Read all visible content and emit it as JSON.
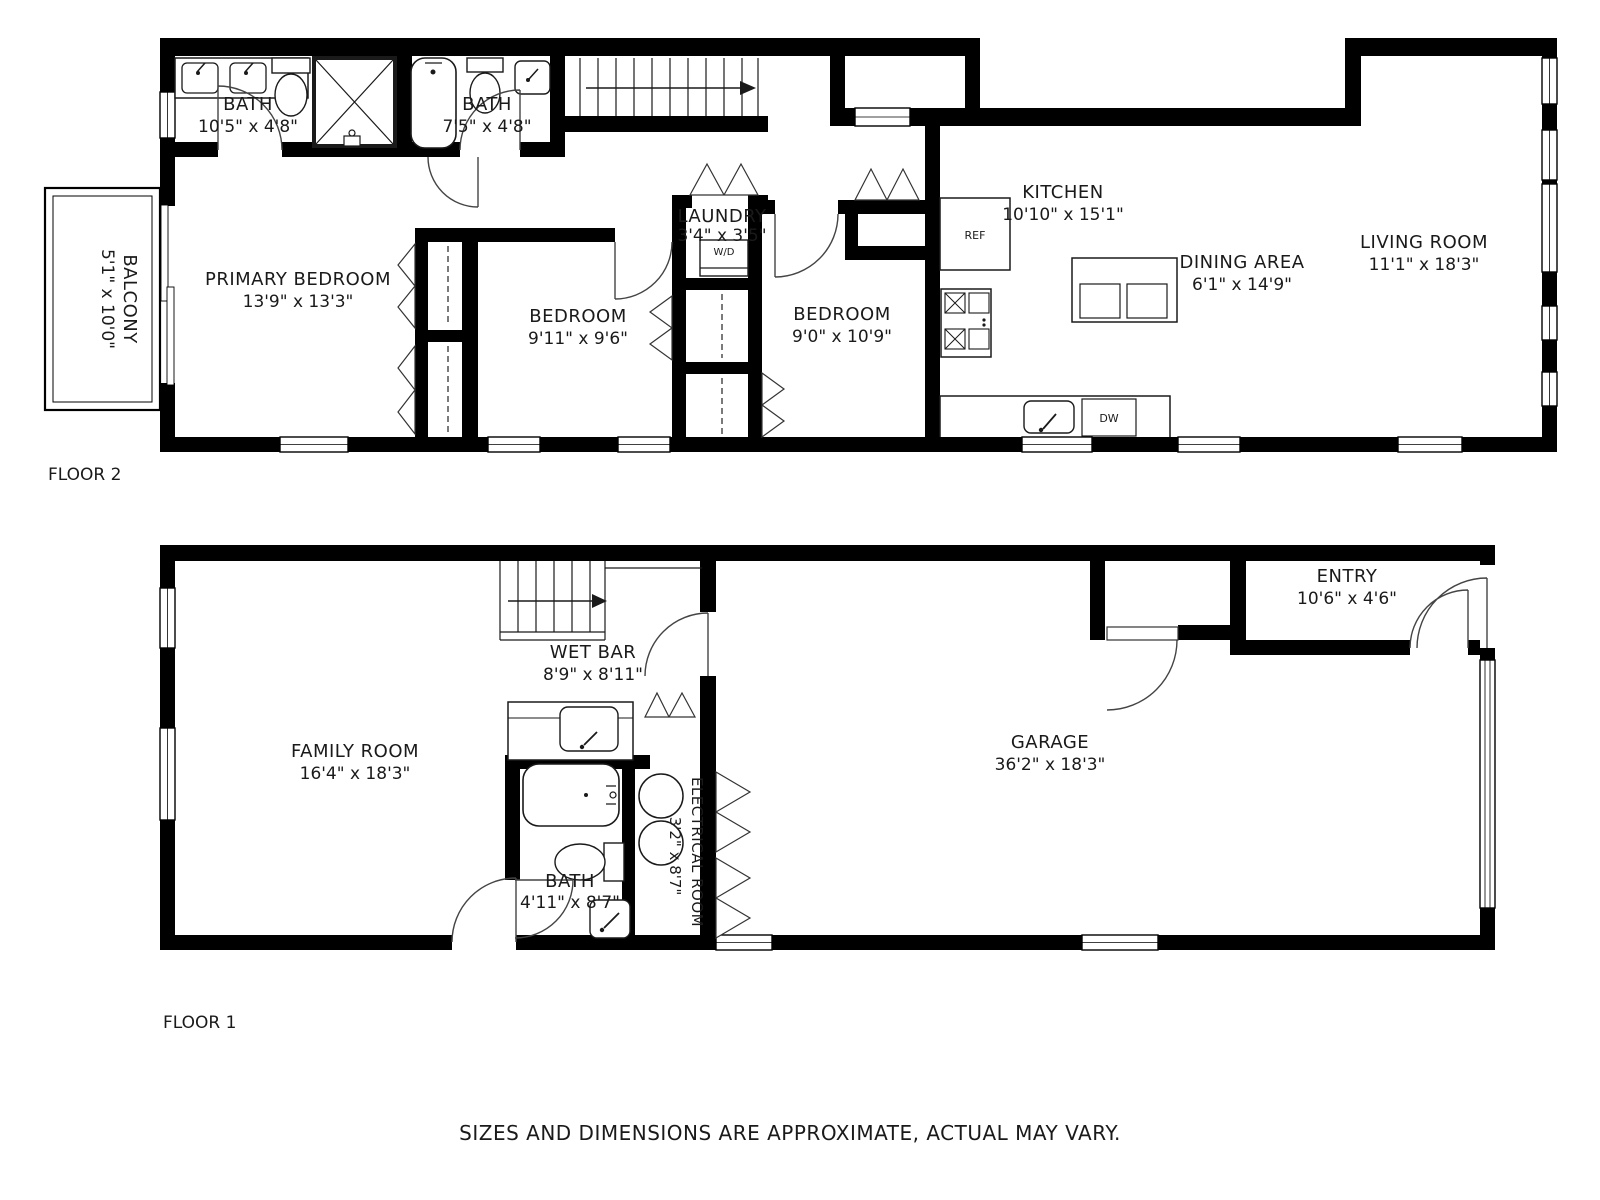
{
  "floors": [
    {
      "label": "FLOOR 2",
      "rooms": [
        {
          "name": "BATH",
          "dims": "10'5\" x 4'8\""
        },
        {
          "name": "BATH",
          "dims": "7'5\" x 4'8\""
        },
        {
          "name": "PRIMARY BEDROOM",
          "dims": "13'9\" x 13'3\""
        },
        {
          "name": "BEDROOM",
          "dims": "9'11\" x 9'6\""
        },
        {
          "name": "LAUNDRY",
          "dims": "3'4\" x 3'5\""
        },
        {
          "name": "BEDROOM",
          "dims": "9'0\" x 10'9\""
        },
        {
          "name": "KITCHEN",
          "dims": "10'10\" x 15'1\""
        },
        {
          "name": "DINING AREA",
          "dims": "6'1\" x 14'9\""
        },
        {
          "name": "LIVING ROOM",
          "dims": "11'1\" x 18'3\""
        },
        {
          "name": "BALCONY",
          "dims": "5'1\" x 10'0\""
        }
      ],
      "appliances": {
        "refrigerator": "REF",
        "washer_dryer": "W/D",
        "dishwasher": "DW"
      }
    },
    {
      "label": "FLOOR 1",
      "rooms": [
        {
          "name": "FAMILY ROOM",
          "dims": "16'4\" x 18'3\""
        },
        {
          "name": "WET BAR",
          "dims": "8'9\" x 8'11\""
        },
        {
          "name": "BATH",
          "dims": "4'11\" x 8'7\""
        },
        {
          "name": "ELECTRICAL ROOM",
          "dims": "3'2\" x 8'7\""
        },
        {
          "name": "GARAGE",
          "dims": "36'2\" x 18'3\""
        },
        {
          "name": "ENTRY",
          "dims": "10'6\" x 4'6\""
        }
      ]
    }
  ],
  "footer": {
    "disclaimer": "SIZES AND DIMENSIONS ARE APPROXIMATE, ACTUAL MAY VARY."
  },
  "colors": {
    "wall": "#000000",
    "background": "#ffffff",
    "line": "#333333",
    "disclaimer": "#a8a8a8"
  }
}
